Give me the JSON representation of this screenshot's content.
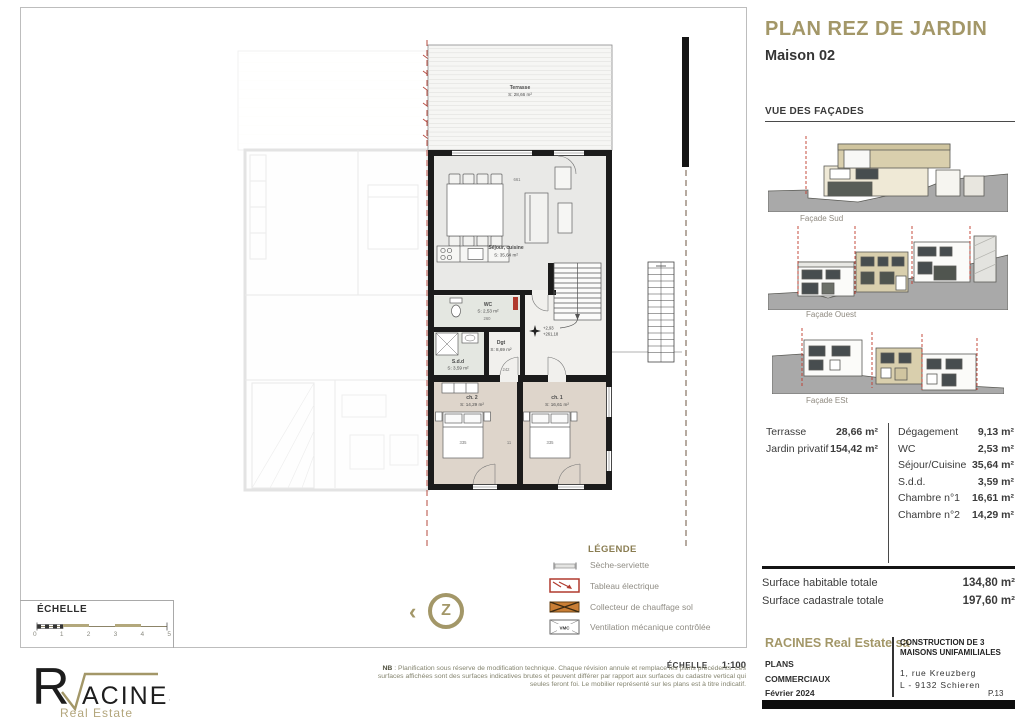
{
  "page": {
    "title": "PLAN REZ DE JARDIN",
    "subtitle": "Maison 02"
  },
  "facades": {
    "heading": "VUE DES FAÇADES",
    "items": [
      {
        "label": "Façade Sud"
      },
      {
        "label": "Façade Ouest"
      },
      {
        "label": "Façade ESt"
      }
    ]
  },
  "areas": {
    "left": [
      {
        "label": "Terrasse",
        "value": "28,66 m²"
      },
      {
        "label": "Jardin privatif",
        "value": "154,42 m²"
      }
    ],
    "right": [
      {
        "label": "Dégagement",
        "value": "9,13 m²"
      },
      {
        "label": "WC",
        "value": "2,53 m²"
      },
      {
        "label": "Séjour/Cuisine",
        "value": "35,64 m²"
      },
      {
        "label": "S.d.d.",
        "value": "3,59 m²"
      },
      {
        "label": "Chambre n°1",
        "value": "16,61 m²"
      },
      {
        "label": "Chambre n°2",
        "value": "14,29 m²"
      }
    ],
    "totals": [
      {
        "label": "Surface habitable totale",
        "value": "134,80 m²"
      },
      {
        "label": "Surface cadastrale totale",
        "value": "197,60 m²"
      }
    ]
  },
  "titleblock": {
    "company": "RACINES Real Estate sa",
    "doc_line1": "PLANS",
    "doc_line2": "COMMERCIAUX",
    "date": "Février 2024",
    "project": "CONSTRUCTION DE 3 MAISONS UNIFAMILIALES",
    "address_line1": "1, rue Kreuzberg",
    "address_line2": "L - 9132 Schieren",
    "page_number": "P.13"
  },
  "legend": {
    "heading": "LÉGENDE",
    "items": [
      {
        "icon": "towel-radiator",
        "label": "Sèche-serviette"
      },
      {
        "icon": "electrical-panel",
        "label": "Tableau électrique"
      },
      {
        "icon": "floor-heating-collector",
        "label": "Collecteur de chauffage sol"
      },
      {
        "icon": "vmc-box",
        "label": "Ventilation mécanique contrôlée"
      }
    ],
    "vmc_label": "VMC"
  },
  "scale": {
    "heading": "ÉCHELLE",
    "ticks": [
      "0",
      "1",
      "2",
      "3",
      "4",
      "5"
    ],
    "ratio_label": "ÉCHELLE",
    "ratio_value": "1:100"
  },
  "notes": {
    "prefix": "NB",
    "body": " : Planification sous réserve de modification technique. Chaque révision annule et remplace les plans précédents. Les surfaces affichées sont des surfaces indicatives brutes et peuvent différer par rapport aux surfaces du cadastre vertical qui seules feront foi. Le mobilier représenté sur les plans est à titre indicatif."
  },
  "logo": {
    "letter": "R",
    "name_rest": "ACINES",
    "tagline": "Real Estate"
  },
  "compass": {
    "chevron": "‹",
    "glyph": "Z"
  },
  "plan": {
    "rooms": {
      "terrasse": {
        "name": "Terrasse",
        "area": "S: 28,66 m²"
      },
      "sejour": {
        "name": "Séjour, cuisine",
        "area": "S: 35,64 m²"
      },
      "wc": {
        "name": "WC",
        "area": "S: 2,53 m²"
      },
      "sdd": {
        "name": "S.d.d",
        "area": "S: 3,59 m²"
      },
      "dgt": {
        "name": "Dgt",
        "area": "S: 8,69 m²"
      },
      "ch2": {
        "name": "ch. 2",
        "area": "S: 14,29 m²"
      },
      "ch1": {
        "name": "ch. 1",
        "area": "S: 16,61 m²"
      }
    },
    "elevation": {
      "line1": "+2,93",
      "line2": "+261,18"
    },
    "dims": {
      "d661": "661",
      "d335a": "335",
      "d335b": "335",
      "d242": "242",
      "d260": "260",
      "d11": "11"
    }
  },
  "colors": {
    "accent_gold": "#a39768",
    "axis_red": "#c0392b",
    "wall_black": "#1b1b1b",
    "bedroom_floor": "#ded5cb",
    "facade_tan": "#d9cfad"
  }
}
